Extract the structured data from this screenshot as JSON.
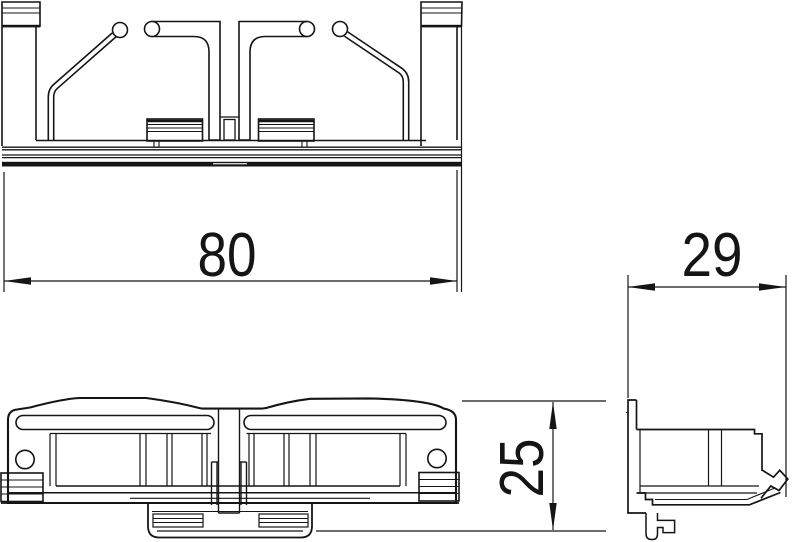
{
  "drawing": {
    "type": "technical-dimension-drawing",
    "views": {
      "top_view": "plan view with spring clips and mounting rail",
      "front_view": "front elevation of clip body",
      "side_view": "side profile with rail claw"
    },
    "colors": {
      "background": "#ffffff",
      "line": "#151515"
    },
    "dimensions": {
      "top_width": "80",
      "front_height": "25",
      "side_depth": "29"
    }
  }
}
